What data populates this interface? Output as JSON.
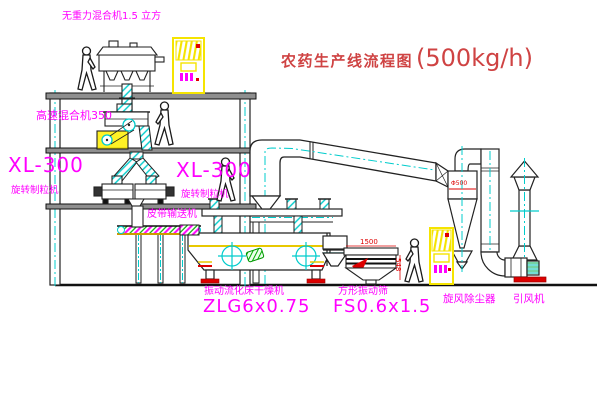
{
  "title": {
    "text": "农药生产线流程图",
    "capacity": "(500kg/h)"
  },
  "labels": {
    "gravity_mixer": "无重力混合机1.5 立方",
    "high_speed_mixer": "高速混合机350",
    "granulator_left_model": "XL-300",
    "granulator_left_name": "旋转制粒机",
    "granulator_right_model": "XL-300",
    "granulator_right_name": "旋转制粒机",
    "belt_conveyor": "皮带输送机",
    "fluid_bed_dryer": "振动流化床干燥机",
    "fluid_bed_dryer_model": "ZLG6x0.75",
    "vibrating_screen": "方形振动筛",
    "vibrating_screen_model": "FS0.6x1.5",
    "cyclone": "旋风除尘器",
    "induced_draft_fan": "引风机"
  },
  "dimensions": {
    "screen_length": "1500",
    "screen_height": "548",
    "cyclone_diameter": "Φ500"
  },
  "colors": {
    "label_magenta": "#ff00ff",
    "title_red": "#cf4343",
    "dimension_red": "#dd0000",
    "centerline_cyan": "#00cccc",
    "cabinet_yellow": "#f5e400"
  }
}
